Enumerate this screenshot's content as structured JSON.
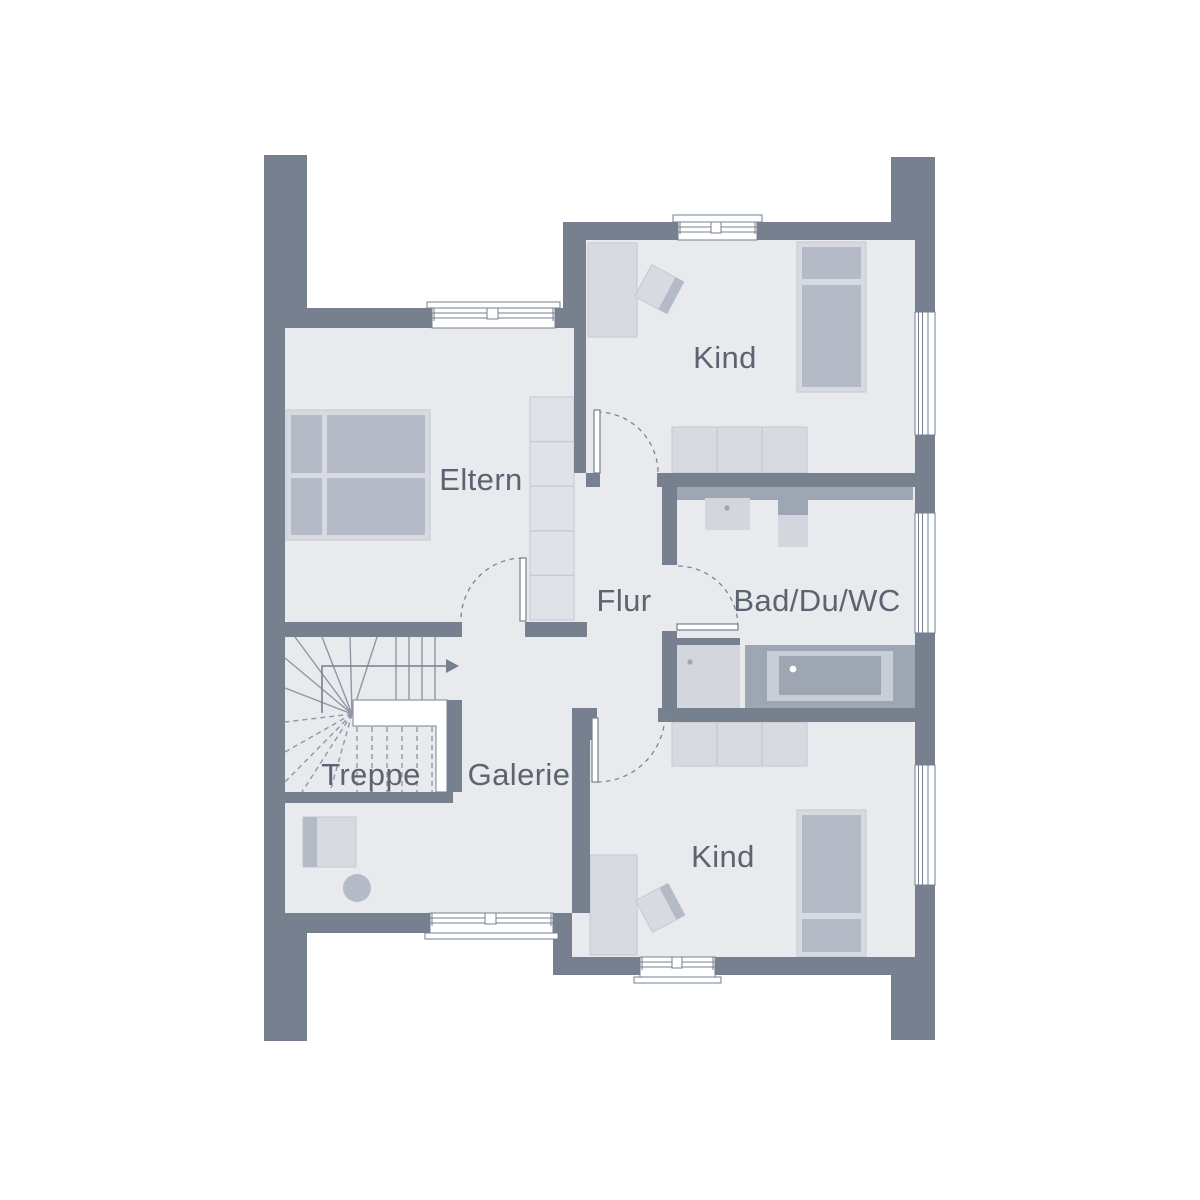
{
  "plan": {
    "type": "floor-plan",
    "floor": "upper-floor"
  },
  "rooms": [
    {
      "id": "kind-top",
      "label": "Kind"
    },
    {
      "id": "eltern",
      "label": "Eltern"
    },
    {
      "id": "flur",
      "label": "Flur"
    },
    {
      "id": "bad-du-wc",
      "label": "Bad/Du/WC"
    },
    {
      "id": "treppe",
      "label": "Treppe"
    },
    {
      "id": "galerie",
      "label": "Galerie"
    },
    {
      "id": "kind-bottom",
      "label": "Kind"
    }
  ],
  "palette": {
    "background": "#FFFFFF",
    "wall": "#76808F",
    "floor": "#E8EAEE",
    "furniture-light": "#D7DAE0",
    "furniture-medium": "#B5BBC6",
    "fixture": "#9EA6B3",
    "fixture-light": "#D3D6DC",
    "tub-body": "#C9CDD5",
    "cabinet": "#DFE2E7",
    "outline": "#C5C9D1",
    "stair-line": "#8D97A5",
    "swing": "#7B8593",
    "label": "#5B6470"
  }
}
